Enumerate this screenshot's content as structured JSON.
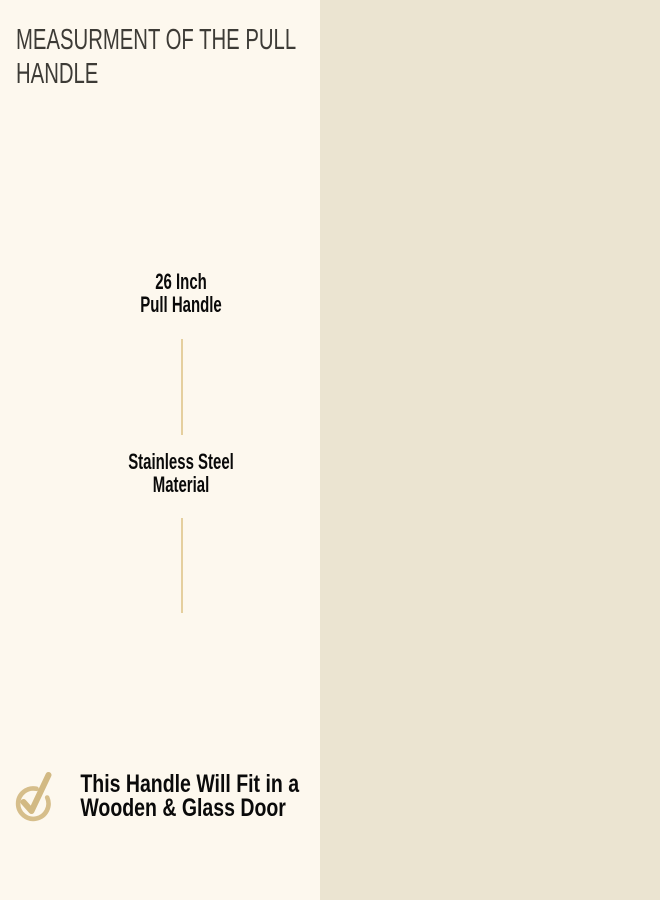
{
  "title": {
    "line1": "MEASURMENT OF THE PULL",
    "line2": "HANDLE"
  },
  "specs": [
    {
      "line1": "26 Inch",
      "line2": "Pull Handle"
    },
    {
      "line1": "Stainless Steel",
      "line2": "Material"
    }
  ],
  "footer_note": {
    "line1": "This Handle Will Fit in a",
    "line2": "Wooden & Glass Door"
  },
  "diagram": {
    "hole_to_hole_label": "Hole To Hole 26 Inch",
    "overall_length": {
      "line1": "36",
      "line2": "Inch"
    }
  },
  "icons": {
    "check_circle": "check-circle-icon"
  },
  "colors": {
    "left_bg": "#fdf8ee",
    "right_bg": "#ebe4d1",
    "title_text": "#3d3b36",
    "body_text": "#0a0a0a",
    "label_text": "#35322c",
    "divider_gold": "#e5cf9e",
    "check_gold": "#d6be8b",
    "dimension_line": "#17140e",
    "brass_light": "#eccf8d",
    "brass_dark": "#7a5a26"
  }
}
